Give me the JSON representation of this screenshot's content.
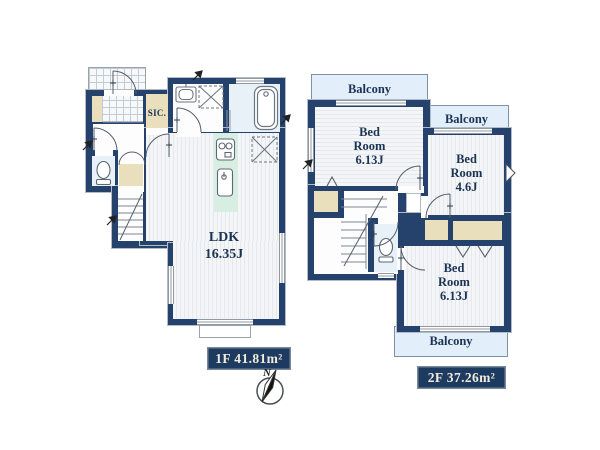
{
  "floor1": {
    "area_label": "1F 41.81m²",
    "ldk_label": {
      "name": "LDK",
      "size": "16.35J"
    },
    "sic_label": "SIC."
  },
  "floor2": {
    "area_label": "2F 37.26m²",
    "bedroom_top_left": {
      "l1": "Bed",
      "l2": "Room",
      "l3": "6.13J"
    },
    "bedroom_right": {
      "l1": "Bed",
      "l2": "Room",
      "l3": "4.6J"
    },
    "bedroom_bottom_right": {
      "l1": "Bed",
      "l2": "Room",
      "l3": "6.13J"
    },
    "balcony_top": "Balcony",
    "balcony_right": "Balcony",
    "balcony_bottom": "Balcony"
  },
  "compass": {
    "north_label": "N"
  },
  "colors": {
    "wall": "#24426b",
    "ink": "#1c3354",
    "label_bg": "#1d3a60",
    "label_text": "#f1ecdc",
    "balcony_fill": "#e2eefa",
    "closet_fill": "#eadfbd",
    "wet_fill": "#e8f0f8",
    "counter_fill": "#d9eee3",
    "line": "#75808c"
  }
}
